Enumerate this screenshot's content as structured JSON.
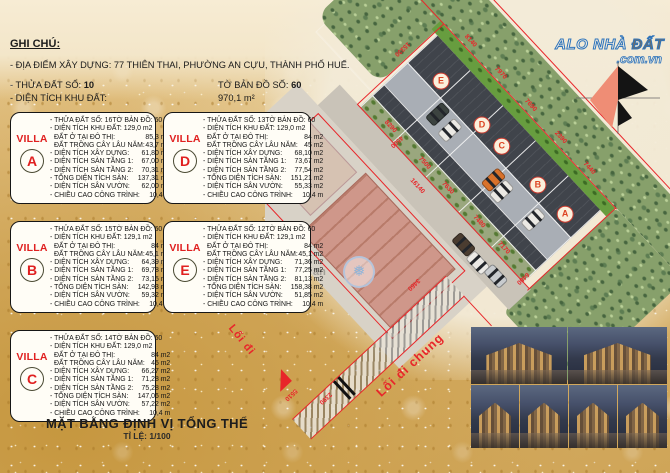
{
  "header": {
    "note": "GHI CHÚ:",
    "address": "- ĐỊA ĐIỂM XÂY DỰNG: 77 THIÊN THAI, PHƯỜNG AN CỰU, THÀNH PHỐ HUẾ.",
    "plot_label": "- THỬA ĐẤT SỐ:",
    "plot_number": "10",
    "sheet_label": "TỜ BẢN ĐỒ SỐ:",
    "sheet_number": "60",
    "area_label": "- DIỆN TÍCH KHU ĐẤT:",
    "area_value": "970,1 m²"
  },
  "villa_word": "VILLA",
  "villas": [
    {
      "letter": "A",
      "plot": "- THỬA ĐẤT SỐ: 16",
      "sheet": "TỜ BẢN ĐỒ: 60",
      "area": "- DIỆN TÍCH KHU ĐẤT: 129,0 m2",
      "rows": [
        {
          "l": "ĐẤT Ở TẠI ĐÔ THỊ:",
          "v": "85,3 m2"
        },
        {
          "l": "ĐẤT TRỒNG CÂY LÂU NĂM:",
          "v": "43,7 m2"
        },
        {
          "l": "- DIỆN TÍCH XÂY DỰNG:",
          "v": "61,80 m2"
        },
        {
          "l": "- DIỆN TÍCH SÀN TẦNG 1:",
          "v": "67,00 m2"
        },
        {
          "l": "- DIỆN TÍCH SÀN TẦNG 2:",
          "v": "70,31 m2"
        },
        {
          "l": "- TỔNG DIỆN TÍCH SÀN:",
          "v": "137,31 m2"
        },
        {
          "l": "- DIỆN TÍCH SÂN VƯỜN:",
          "v": "62,00 m2"
        },
        {
          "l": "- CHIỀU CAO CÔNG TRÌNH:",
          "v": "10,4 m"
        }
      ]
    },
    {
      "letter": "D",
      "plot": "- THỬA ĐẤT SỐ: 13",
      "sheet": "TỜ BẢN ĐỒ: 60",
      "area": "- DIỆN TÍCH KHU ĐẤT: 129,0 m2",
      "rows": [
        {
          "l": "ĐẤT Ở TẠI ĐÔ THỊ:",
          "v": "84 m2"
        },
        {
          "l": "ĐẤT TRỒNG CÂY LÂU NĂM:",
          "v": "45 m2"
        },
        {
          "l": "- DIỆN TÍCH XÂY DỰNG:",
          "v": "68,10 m2"
        },
        {
          "l": "- DIỆN TÍCH SÀN TẦNG 1:",
          "v": "73,67 m2"
        },
        {
          "l": "- DIỆN TÍCH SÀN TẦNG 2:",
          "v": "77,54 m2"
        },
        {
          "l": "- TỔNG DIỆN TÍCH SÀN:",
          "v": "151,21 m2"
        },
        {
          "l": "- DIỆN TÍCH SÂN VƯỜN:",
          "v": "55,33 m2"
        },
        {
          "l": "- CHIỀU CAO CÔNG TRÌNH:",
          "v": "10,4 m"
        }
      ]
    },
    {
      "letter": "B",
      "plot": "- THỬA ĐẤT SỐ: 15",
      "sheet": "TỜ BẢN ĐỒ: 60",
      "area": "- DIỆN TÍCH KHU ĐẤT: 129,1 m2",
      "rows": [
        {
          "l": "ĐẤT Ở TẠI ĐÔ THỊ:",
          "v": "84 m2"
        },
        {
          "l": "ĐẤT TRỒNG CÂY LÂU NĂM:",
          "v": "45,1 m2"
        },
        {
          "l": "- DIỆN TÍCH XÂY DỰNG:",
          "v": "64,39 m2"
        },
        {
          "l": "- DIỆN TÍCH SÀN TẦNG 1:",
          "v": "69,78 m2"
        },
        {
          "l": "- DIỆN TÍCH SÀN TẦNG 2:",
          "v": "73,15 m2"
        },
        {
          "l": "- TỔNG DIỆN TÍCH SÀN:",
          "v": "142,93 m2"
        },
        {
          "l": "- DIỆN TÍCH SÂN VƯỜN:",
          "v": "59,32 m2"
        },
        {
          "l": "- CHIỀU CAO CÔNG TRÌNH:",
          "v": "10,4 m"
        }
      ]
    },
    {
      "letter": "E",
      "plot": "- THỬA ĐẤT SỐ: 12",
      "sheet": "TỜ BẢN ĐỒ: 60",
      "area": "- DIỆN TÍCH KHU ĐẤT: 129,1 m2",
      "rows": [
        {
          "l": "ĐẤT Ở TẠI ĐÔ THỊ:",
          "v": "84 m2"
        },
        {
          "l": "ĐẤT TRỒNG CÂY LÂU NĂM:",
          "v": "45,1 m2"
        },
        {
          "l": "- DIỆN TÍCH XÂY DỰNG:",
          "v": "71,36 m2"
        },
        {
          "l": "- DIỆN TÍCH SÀN TẦNG 1:",
          "v": "77,25 m2"
        },
        {
          "l": "- DIỆN TÍCH SÀN TẦNG 2:",
          "v": "81,13 m2"
        },
        {
          "l": "- TỔNG DIỆN TÍCH SÀN:",
          "v": "158,38 m2"
        },
        {
          "l": "- DIỆN TÍCH SÂN VƯỜN:",
          "v": "51,85 m2"
        },
        {
          "l": "- CHIỀU CAO CÔNG TRÌNH:",
          "v": "10,4 m"
        }
      ]
    },
    {
      "letter": "C",
      "plot": "- THỬA ĐẤT SỐ: 14",
      "sheet": "TỜ BẢN ĐỒ: 60",
      "area": "- DIỆN TÍCH KHU ĐẤT: 129,0 m2",
      "rows": [
        {
          "l": "ĐẤT Ở TẠI ĐÔ THỊ:",
          "v": "84 m2"
        },
        {
          "l": "ĐẤT TRỒNG CÂY LÂU NĂM:",
          "v": "45 m2"
        },
        {
          "l": "- DIỆN TÍCH XÂY DỰNG:",
          "v": "66,27 m2"
        },
        {
          "l": "- DIỆN TÍCH SÀN TẦNG 1:",
          "v": "71,28 m2"
        },
        {
          "l": "- DIỆN TÍCH SÀN TẦNG 2:",
          "v": "75,28 m2"
        },
        {
          "l": "- TỔNG DIỆN TÍCH SÀN:",
          "v": "147,06 m2"
        },
        {
          "l": "- DIỆN TÍCH SÂN VƯỜN:",
          "v": "57,22 m2"
        },
        {
          "l": "- CHIỀU CAO CÔNG TRÌNH:",
          "v": "10,4 m"
        }
      ]
    }
  ],
  "footer": {
    "title": "MẶT BẰNG ĐỊNH VỊ TỔNG THỂ",
    "scale": "TỈ LỆ: 1/100"
  },
  "logo": {
    "part1": "ALO NHÀ ",
    "part2": "ĐẤT",
    "domain": ".com.vn"
  },
  "plan": {
    "plots": [
      "E",
      "D",
      "C",
      "B",
      "A"
    ],
    "paths": {
      "loi_di": "Lối đi",
      "loi_di_chung": "Lối đi chung"
    },
    "watermark_text": "an",
    "snow_glyph": "❅",
    "dims": [
      "8140",
      "7970",
      "7690",
      "2390",
      "7440",
      "15330",
      "8290",
      "4500",
      "7500",
      "7630",
      "7480",
      "7170",
      "16140",
      "6480",
      "3460",
      "2390",
      "5510"
    ],
    "colors": {
      "boundary_red": "#e8262a",
      "plot_dark": "#40444b",
      "tree_green": "#87a06b",
      "gold_bg": "#d9b26d"
    }
  }
}
